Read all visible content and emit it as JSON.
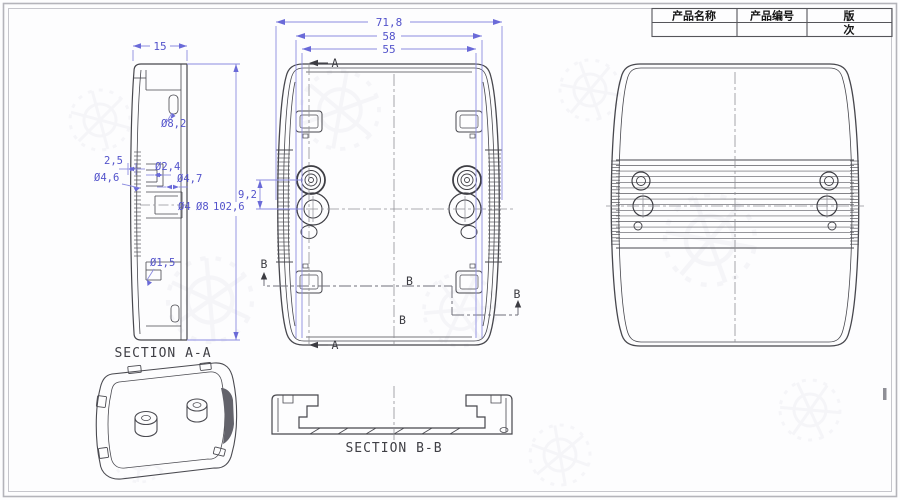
{
  "palette": {
    "dimension_blue": "#5353cb",
    "dimension_line_blue": "#8c8ce0",
    "drawing_line": "#47474d",
    "centerline_gray": "#8f8f96",
    "frame_gray": "#b4b4ba"
  },
  "title_block": {
    "product_name_label": "产品名称",
    "product_code_label": "产品编号",
    "revision_label_line1": "版",
    "revision_label_line2": "次"
  },
  "side_section_view": {
    "label": "SECTION A-A",
    "dim_thickness": "15",
    "dim_slot": "Ø8,2",
    "dim_step": "2,5",
    "dim_boss_outer": "Ø4,6",
    "dim_hole_small": "Ø2,4",
    "dim_boss_mid": "Ø4,7",
    "dim_hole_d4": "Ø4",
    "dim_boss_d8": "Ø8",
    "dim_height": "102,6",
    "dim_hole_tiny": "Ø1,5"
  },
  "front_view": {
    "dim_overall_width": "71,8",
    "dim_width_58": "58",
    "dim_width_55": "55",
    "dim_boss_spacing": "9,2",
    "section_a_marker_top": "A",
    "section_a_marker_bottom": "A",
    "section_b_marker_left": "B",
    "section_b_marker_mid_upper": "B",
    "section_b_marker_mid_lower": "B",
    "section_b_marker_right": "B"
  },
  "section_bb_view": {
    "label": "SECTION B-B"
  }
}
